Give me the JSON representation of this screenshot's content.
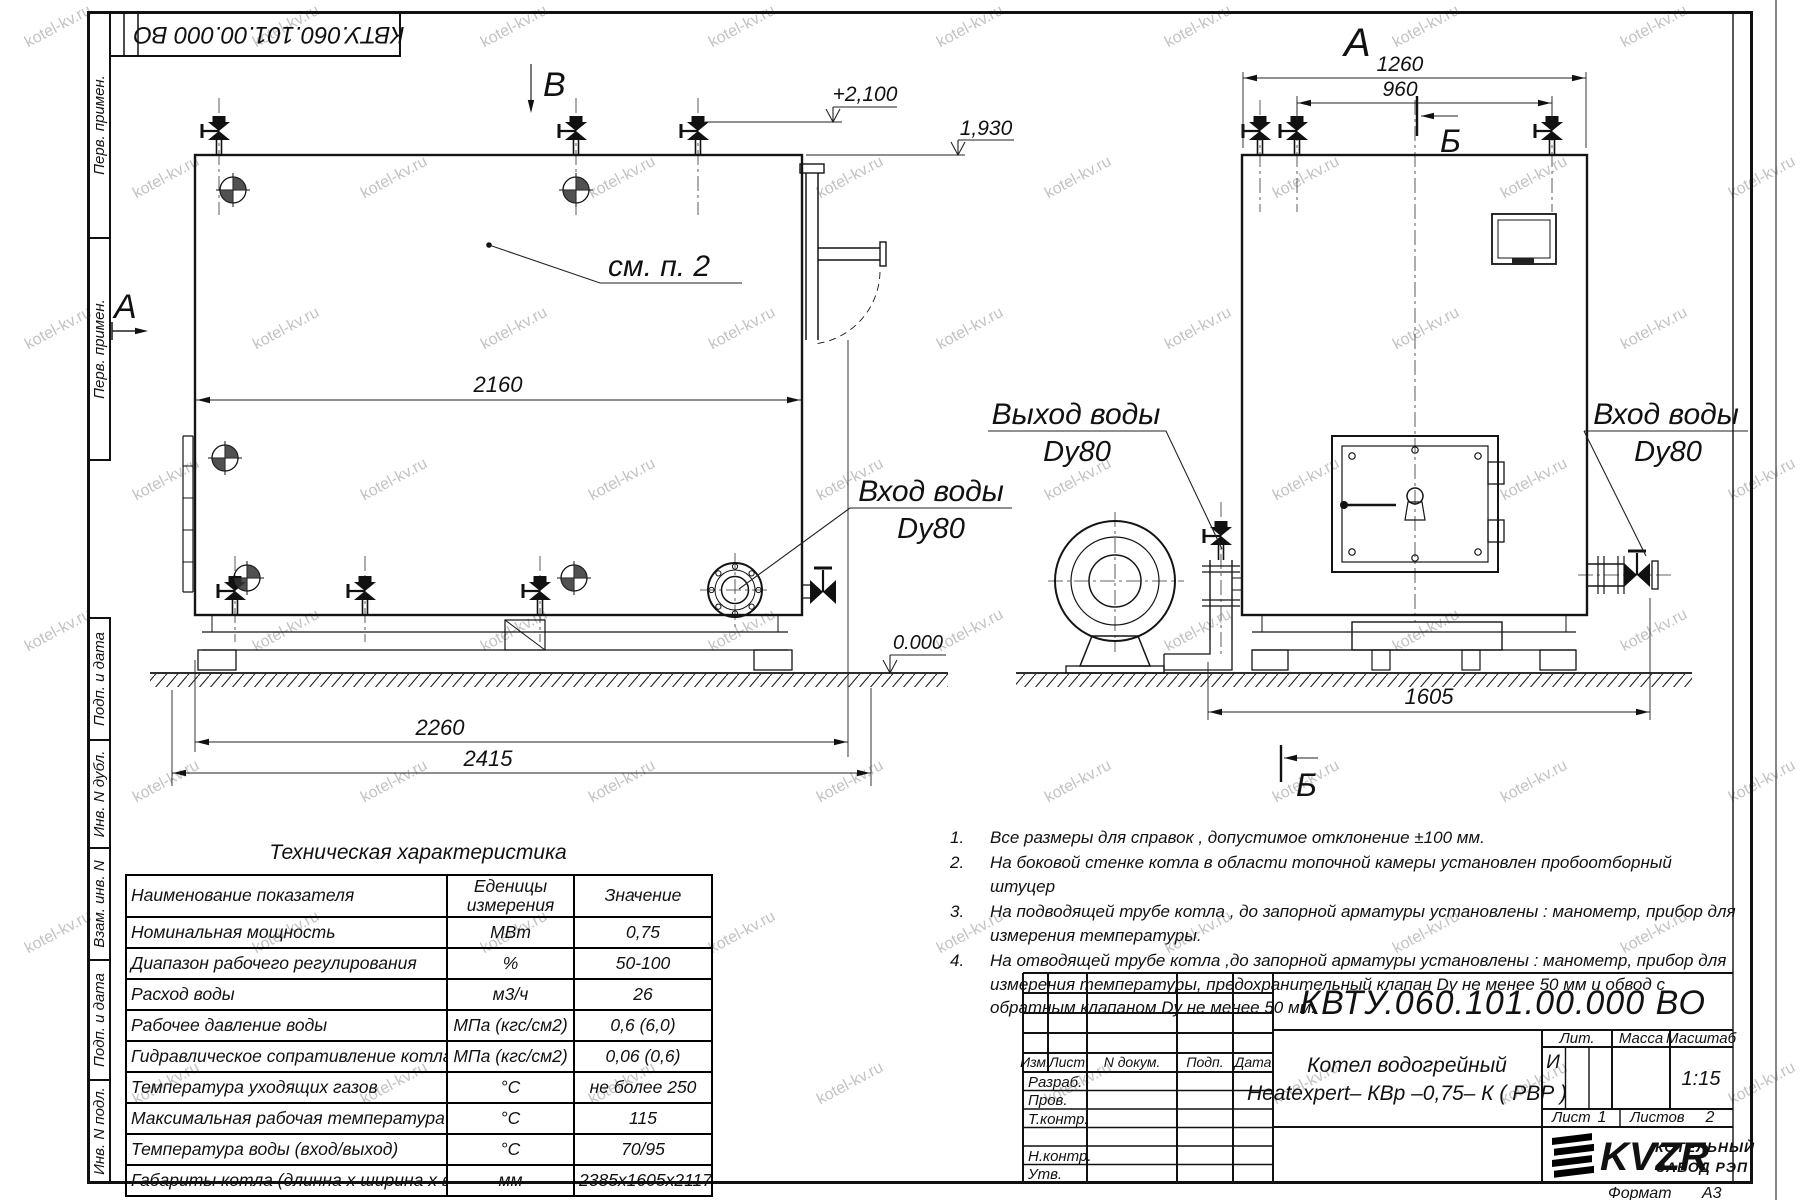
{
  "watermark": {
    "text": "kotel-kv.ru"
  },
  "stamp": {
    "doc_number_rotated": "КВТУ.060.101.00.000  ВО"
  },
  "margin": {
    "labels": [
      "Перв. примен.",
      "Перв. примен.",
      "Подп. и дата",
      "Инв. N дубл.",
      "Взам. инв. N",
      "Подп. и дата",
      "Инв. N подл."
    ]
  },
  "drawing": {
    "view_markers": {
      "a_left": "А",
      "b_top": "В",
      "a_top": "А",
      "b_section_top": "Б",
      "b_section_bottom": "Б"
    },
    "labels": {
      "see_item": "см. п. 2",
      "inlet_front": {
        "title": "Вход воды",
        "size": "Dy80"
      },
      "outlet_side": {
        "title": "Выход воды",
        "size": "Dy80"
      },
      "inlet_side": {
        "title": "Вход воды",
        "size": "Dy80"
      }
    },
    "levels": {
      "top": "+2,100",
      "mid": "1,930",
      "zero": "0.000"
    },
    "dims": {
      "front_width": "2160",
      "front_base": "2260",
      "front_total": "2415",
      "side_top": "1260",
      "side_top_inner": "960",
      "side_base": "1605"
    }
  },
  "tech_table": {
    "title": "Техническая характеристика",
    "col_name": "Наименование показателя",
    "col_units": "Еденицы измерения",
    "col_value": "Значение",
    "rows": [
      [
        "Номинальная мощность",
        "МВт",
        "0,75"
      ],
      [
        "Диапазон рабочего регулирования",
        "%",
        "50-100"
      ],
      [
        "Расход воды",
        "м3/ч",
        "26"
      ],
      [
        "Рабочее давление воды",
        "МПа (кгс/см2)",
        "0,6 (6,0)"
      ],
      [
        "Гидравлическое сопративление котла",
        "МПа (кгс/см2)",
        "0,06 (0,6)"
      ],
      [
        "Температура уходящих газов",
        "°С",
        "не более 250"
      ],
      [
        "Максимальная рабочая температура воды",
        "°С",
        "115"
      ],
      [
        "Температура воды (вход/выход)",
        "°С",
        "70/95"
      ],
      [
        "Габариты котла (длинна х ширина х высота)",
        "мм",
        "2385х1605х2117"
      ]
    ]
  },
  "notes": {
    "items": [
      {
        "num": "1.",
        "text": "Все размеры для справок , допустимое отклонение  ±100 мм."
      },
      {
        "num": "2.",
        "text": "На боковой стенке котла в области топочной камеры установлен пробоотборный штуцер"
      },
      {
        "num": "3.",
        "text": "На  подводящей трубе котла , до запорной арматуры установлены : манометр, прибор для измерения температуры."
      },
      {
        "num": "4.",
        "text": "На отводящей трубе котла ,до запорной арматуры установлены : манометр, прибор для измерения температуры, предохранительный клапан  Dу не менее  50 мм и обвод с обратным клапаном  Dу не менее  50 мм."
      }
    ]
  },
  "title_block": {
    "doc_number": "КВТУ.060.101.00.000  ВО",
    "name_line1": "Котел водогрейный",
    "name_line2": "Heatexpert– КВр –0,75– К ( РВР )",
    "header": {
      "izm": "Изм.",
      "list": "Лист",
      "n_dokum": "N докум.",
      "podp": "Подп.",
      "data": "Дата"
    },
    "sign_rows": [
      "Разраб.",
      "Пров.",
      "Т.контр.",
      "",
      "Н.контр.",
      "Утв."
    ],
    "lit": {
      "label": "Лит.",
      "value": "И"
    },
    "massa": {
      "label": "Масса",
      "value": ""
    },
    "masshtab": {
      "label": "Масштаб",
      "value": "1:15"
    },
    "list": {
      "label": "Лист",
      "value": "1"
    },
    "listov": {
      "label": "Листов",
      "value": "2"
    },
    "company": {
      "logo": "KVZR",
      "line1": "КОТЕЛЬНЫЙ",
      "line2": "ЗАВОД РЭП"
    },
    "format": {
      "label": "Формат",
      "value": "А3"
    }
  }
}
